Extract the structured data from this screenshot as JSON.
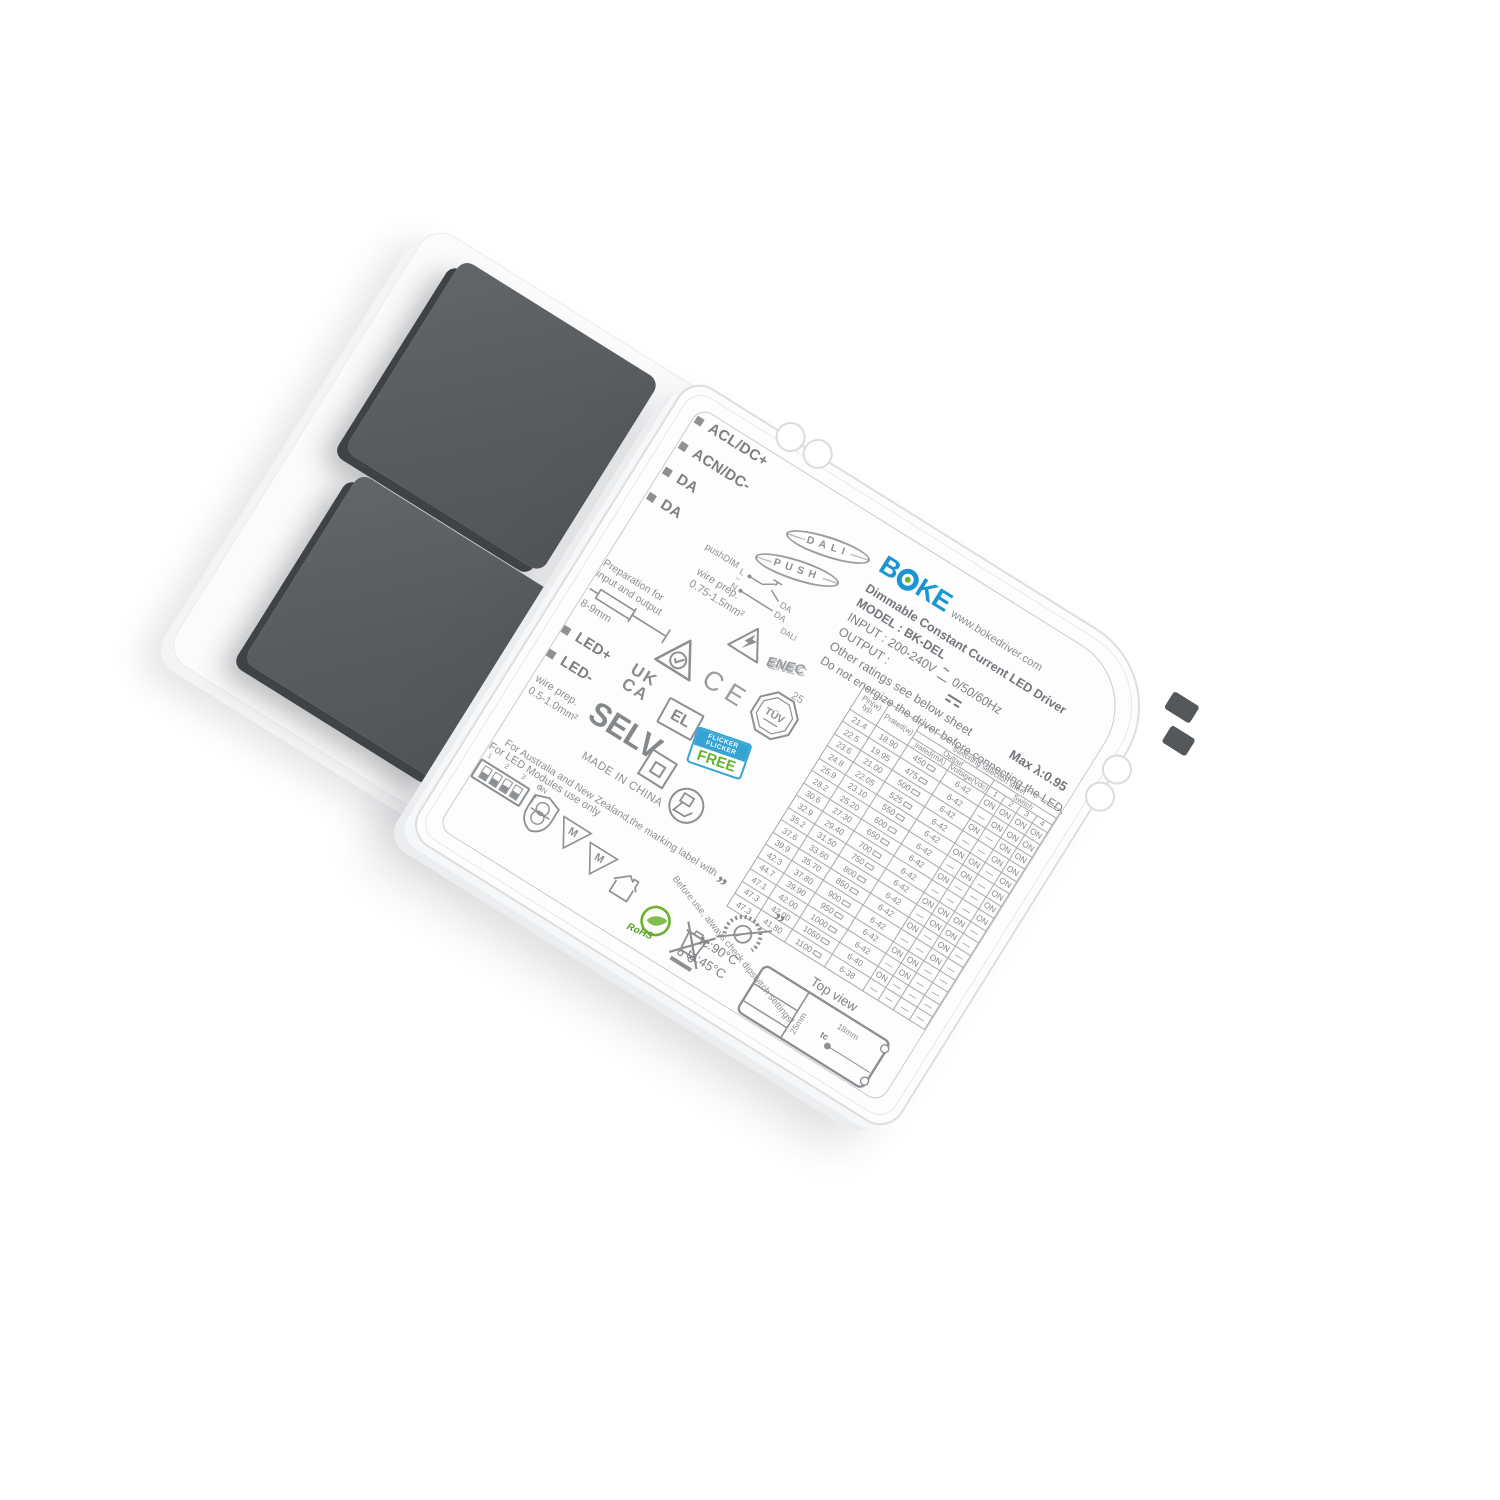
{
  "device": {
    "brand": {
      "logo_b": "B",
      "logo_ke": "KE",
      "website": "www.bokedriver.com",
      "blue": "#1a96d2",
      "green": "#6ab32c"
    },
    "terminals": [
      {
        "label": "ACL/DC+"
      },
      {
        "label": "ACN/DC-"
      },
      {
        "label": "DA"
      },
      {
        "label": "DA"
      }
    ],
    "badges": {
      "dali": "DALI",
      "push": "PUSH"
    },
    "pushdim": {
      "label": "pushDIM",
      "l": "L",
      "n": "N",
      "da1": "DA",
      "da2": "DA",
      "dali": "DALI"
    },
    "info": {
      "title": "Dimmable Constant Current LED Driver",
      "model": "MODEL : BK-DEL",
      "input_a": "INPUT : 200-240V",
      "input_b": "0/50/60Hz",
      "output": "OUTPUT :",
      "ratings": "Other ratings see below sheet",
      "warning": "Do not energize the driver before connecting the LED.",
      "max_lambda": "Max λ:0.95"
    },
    "table": {
      "headers": {
        "pin_1": "Pin(w)",
        "pin_2": "typ.",
        "prated": "Prated(w)",
        "sss": "Switching selection sheet",
        "output": "Output",
        "switch": "Switch",
        "irated": "Irated(mA)",
        "voltage": "Voltage(Vdc)",
        "s1": "1",
        "s2": "2",
        "s3": "3",
        "s4": "4"
      },
      "rows": [
        {
          "pin": "21.4",
          "prated": "18.90",
          "irated": "450",
          "voltage": "6-42",
          "sw": [
            "ON",
            "ON",
            "ON",
            "ON"
          ]
        },
        {
          "pin": "22.5",
          "prated": "19.95",
          "irated": "475",
          "voltage": "6-42",
          "sw": [
            "—",
            "ON",
            "ON",
            "ON"
          ]
        },
        {
          "pin": "23.6",
          "prated": "21.00",
          "irated": "500",
          "voltage": "6-42",
          "sw": [
            "ON",
            "—",
            "ON",
            "ON"
          ]
        },
        {
          "pin": "24.8",
          "prated": "22.05",
          "irated": "525",
          "voltage": "6-42",
          "sw": [
            "—",
            "—",
            "ON",
            "ON"
          ]
        },
        {
          "pin": "25.9",
          "prated": "23.10",
          "irated": "550",
          "voltage": "6-42",
          "sw": [
            "ON",
            "ON",
            "—",
            "ON"
          ]
        },
        {
          "pin": "28.2",
          "prated": "25.20",
          "irated": "600",
          "voltage": "6-42",
          "sw": [
            "—",
            "ON",
            "—",
            "ON"
          ]
        },
        {
          "pin": "30.6",
          "prated": "27.30",
          "irated": "650",
          "voltage": "6-42",
          "sw": [
            "ON",
            "—",
            "—",
            "ON"
          ]
        },
        {
          "pin": "32.9",
          "prated": "29.40",
          "irated": "700",
          "voltage": "6-42",
          "sw": [
            "—",
            "—",
            "—",
            "ON"
          ]
        },
        {
          "pin": "35.2",
          "prated": "31.50",
          "irated": "750",
          "voltage": "6-42",
          "sw": [
            "ON",
            "ON",
            "ON",
            "—"
          ]
        },
        {
          "pin": "37.6",
          "prated": "33.60",
          "irated": "800",
          "voltage": "6-42",
          "sw": [
            "—",
            "ON",
            "ON",
            "—"
          ]
        },
        {
          "pin": "39.9",
          "prated": "35.70",
          "irated": "850",
          "voltage": "6-42",
          "sw": [
            "ON",
            "—",
            "ON",
            "—"
          ]
        },
        {
          "pin": "42.3",
          "prated": "37.80",
          "irated": "900",
          "voltage": "6-42",
          "sw": [
            "—",
            "—",
            "ON",
            "—"
          ]
        },
        {
          "pin": "44.7",
          "prated": "39.90",
          "irated": "950",
          "voltage": "6-42",
          "sw": [
            "ON",
            "ON",
            "—",
            "—"
          ]
        },
        {
          "pin": "47.1",
          "prated": "42.00",
          "irated": "1000",
          "voltage": "6-42",
          "sw": [
            "—",
            "ON",
            "—",
            "—"
          ]
        },
        {
          "pin": "47.3",
          "prated": "42.00",
          "irated": "1050",
          "voltage": "6-40",
          "sw": [
            "ON",
            "—",
            "—",
            "—"
          ]
        },
        {
          "pin": "47.3",
          "prated": "41.80",
          "irated": "1100",
          "voltage": "6-38",
          "sw": [
            "—",
            "—",
            "—",
            "—"
          ]
        }
      ],
      "before_use": "Before use, always check dipswitch settings!"
    },
    "marks": {
      "wire_prep_1a": "wire prep.",
      "wire_prep_1b": "0.75-1.5mm²",
      "prep_io_a": "Preparation for",
      "prep_io_b": "input and output",
      "strip_len": "8-9mm",
      "enec": "ENEC",
      "enec_num": "25",
      "ce": "CE",
      "tuv": "TÜV",
      "ukca_1": "UK",
      "ukca_2": "CA",
      "el": "EL",
      "flicker_1": "FLICKER",
      "flicker_2": "FLICKER",
      "free": "FREE",
      "led_plus": "LED+",
      "led_minus": "LED-",
      "wire_prep_2a": "wire prep.",
      "wire_prep_2b": "0.5-1.0mm²",
      "selv": "SELV",
      "made": "MADE IN CHINA",
      "aus_line": "For Australia and New Zealand,the marking label with",
      "quote_open": "„",
      "quote_close": "”",
      "led_modules": "For LED Modules use only",
      "dip_numbers": "1 2 3 4",
      "dip_on": "ON",
      "dip_arrow": "↑",
      "m_mark": "M",
      "rohs": "RoHS",
      "tc": "tc:90°C",
      "ta": "ta:45°C",
      "top_view": "Top view",
      "tv_25": "25mm",
      "tv_18": "18mm",
      "tv_tc": "tc"
    }
  }
}
